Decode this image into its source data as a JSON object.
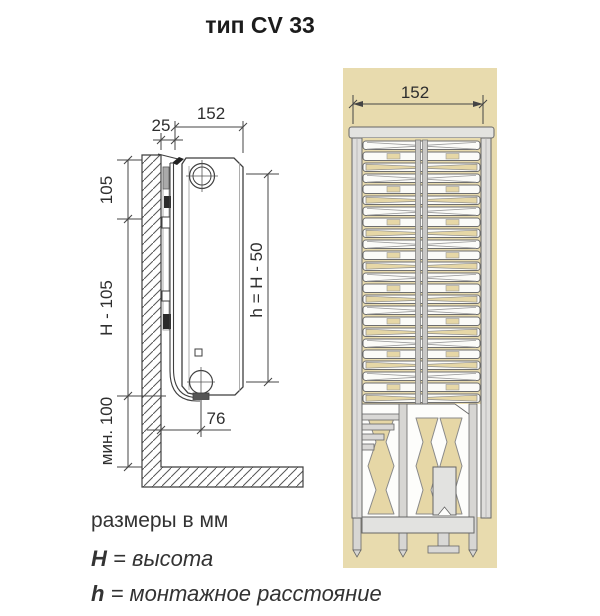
{
  "title": "тип CV 33",
  "side_view": {
    "dim_depth": "152",
    "dim_wall_gap": "25",
    "dim_top_offset": "105",
    "dim_mid_height": "H - 105",
    "dim_min_clearance": "мин. 100",
    "dim_mounting_height": "h = H - 50",
    "dim_connection_offset": "76"
  },
  "front_view": {
    "dim_width": "152"
  },
  "legend": {
    "units_note": "размеры в мм",
    "height_term": {
      "key": "H",
      "rest": " = высота"
    },
    "mount_term": {
      "key": "h",
      "rest": " = монтажное расстояние"
    }
  },
  "colors": {
    "panel_bg": "#e8dbae",
    "fin_tan": "#e6d7a6",
    "slat_white": "#fbfbf8",
    "metal_light": "#e3e3e0",
    "metal_mid": "#d7d6d3",
    "outline_gray": "#666666",
    "drawing_line": "#3f3f3f",
    "text_dark": "#1c1c1c"
  }
}
